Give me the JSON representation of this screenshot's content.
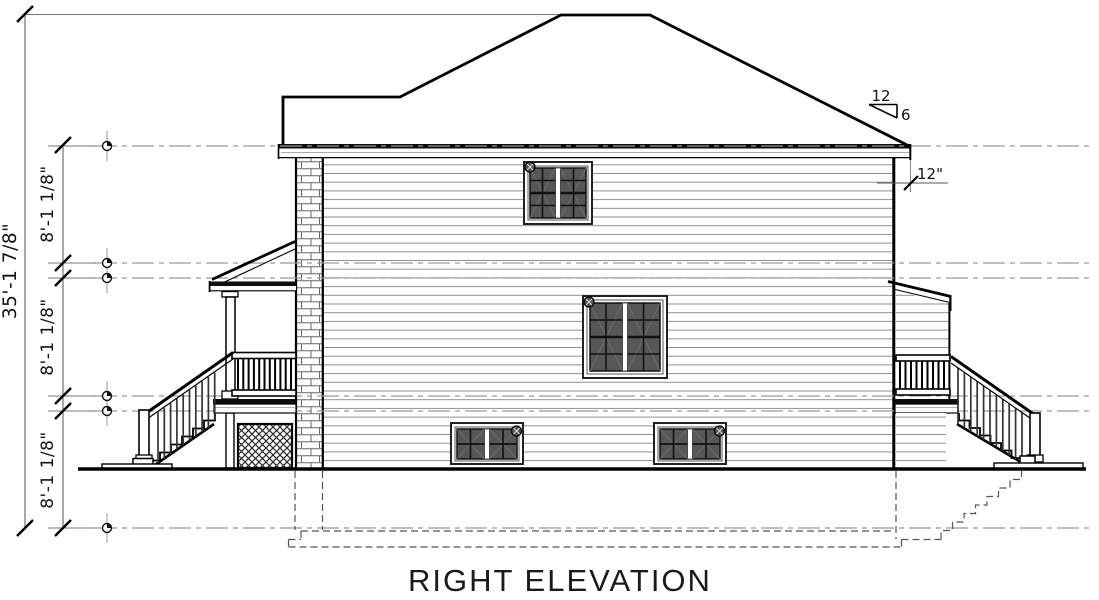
{
  "drawing": {
    "title": "RIGHT ELEVATION",
    "dimensions": {
      "overall_height": "35'-1 7/8\"",
      "floor_upper": "8'-1 1/8\"",
      "floor_middle": "8'-1 1/8\"",
      "floor_lower": "8'-1 1/8\"",
      "eave_overhang": "12\"",
      "pitch_run": "12",
      "pitch_rise": "6"
    },
    "colors": {
      "ink": "#000000",
      "level_line": "#999999",
      "glazing": "#575757",
      "paper": "#ffffff"
    }
  }
}
